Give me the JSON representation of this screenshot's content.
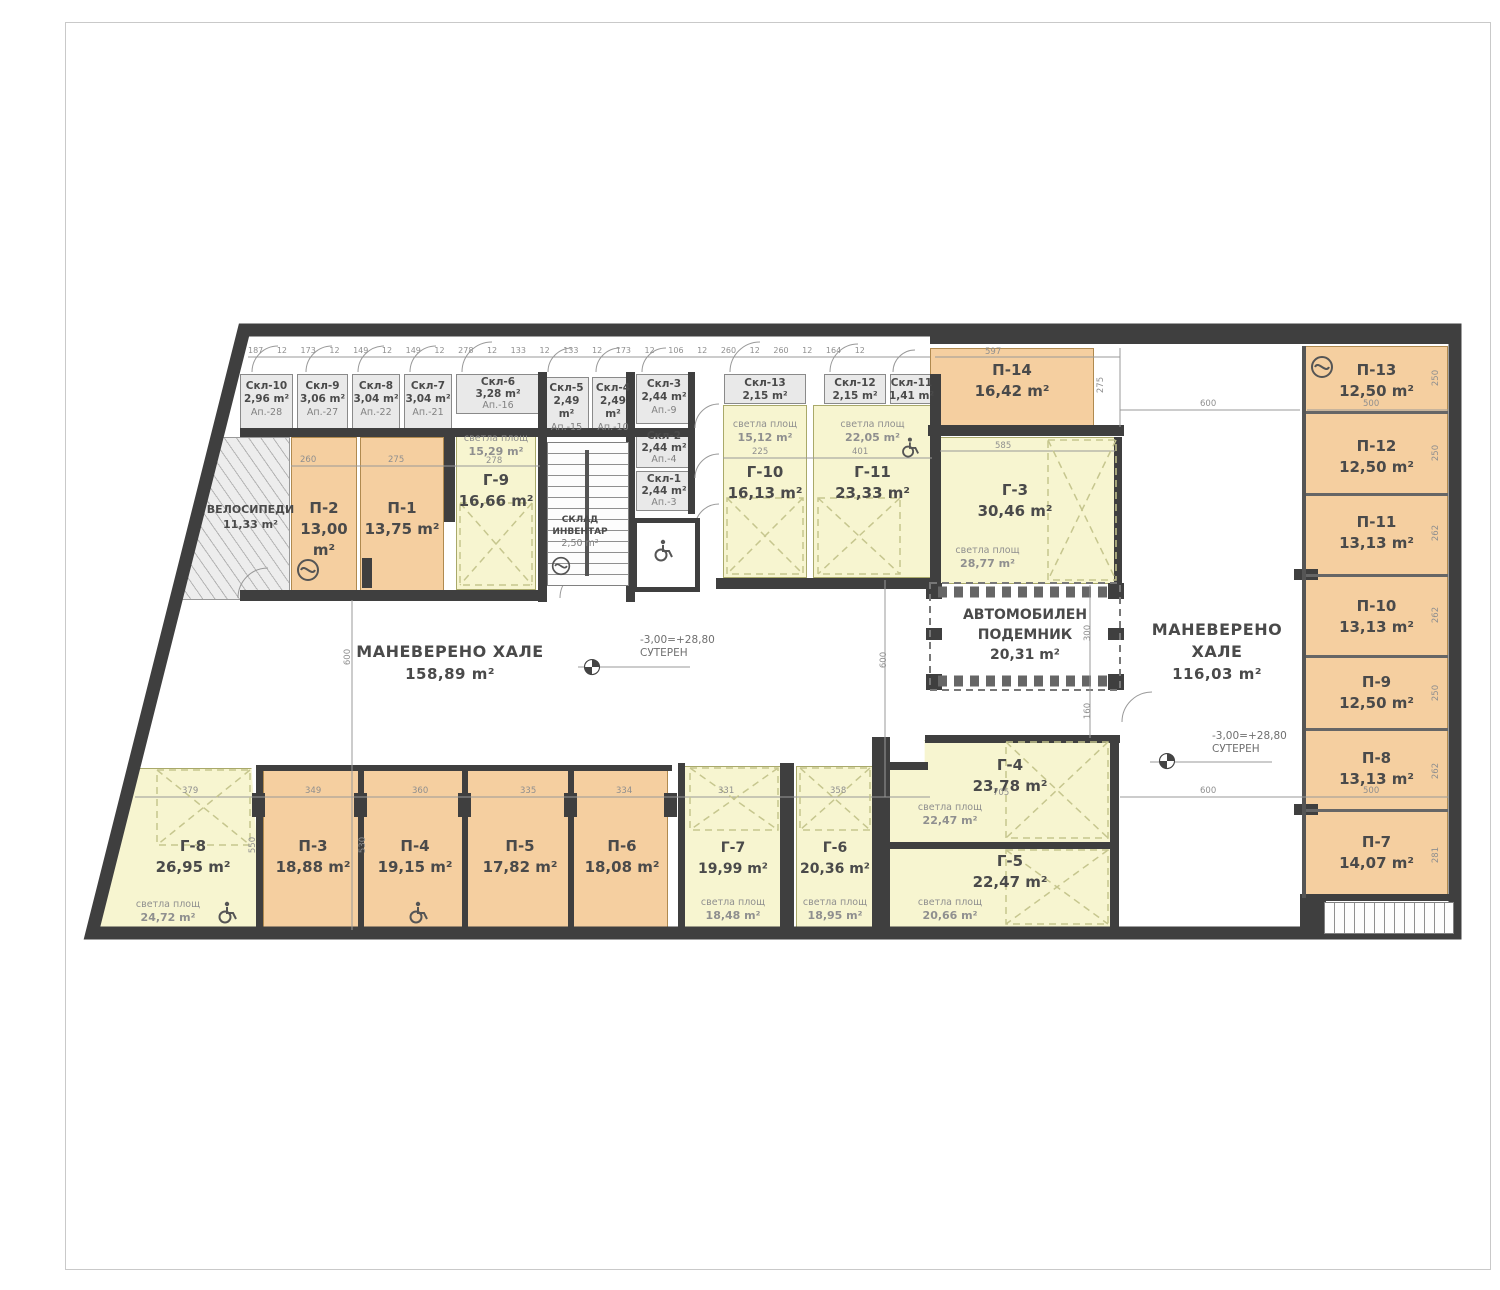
{
  "rooms": {
    "skl10": {
      "name": "Скл-10",
      "area": "2,96 m²",
      "apt": "Ап.-28"
    },
    "skl9": {
      "name": "Скл-9",
      "area": "3,06 m²",
      "apt": "Ап.-27"
    },
    "skl8": {
      "name": "Скл-8",
      "area": "3,04 m²",
      "apt": "Ап.-22"
    },
    "skl7": {
      "name": "Скл-7",
      "area": "3,04 m²",
      "apt": "Ап.-21"
    },
    "skl6": {
      "name": "Скл-6",
      "area": "3,28 m²",
      "apt": "Ап.-16"
    },
    "skl5": {
      "name": "Скл-5",
      "area": "2,49 m²",
      "apt": "Ап.-15"
    },
    "skl4": {
      "name": "Скл-4",
      "area": "2,49 m²",
      "apt": "Ап.-10"
    },
    "skl3": {
      "name": "Скл-3",
      "area": "2,44 m²",
      "apt": "Ап.-9"
    },
    "skl2": {
      "name": "Скл-2",
      "area": "2,44 m²",
      "apt": "Ап.-4"
    },
    "skl1": {
      "name": "Скл-1",
      "area": "2,44 m²",
      "apt": "Ап.-3"
    },
    "skl13": {
      "name": "Скл-13",
      "area": "2,15 m²"
    },
    "skl12": {
      "name": "Скл-12",
      "area": "2,15 m²"
    },
    "skl11": {
      "name": "Скл-11",
      "area": "1,41 m²"
    },
    "p1": {
      "name": "П-1",
      "area": "13,75 m²"
    },
    "p2": {
      "name": "П-2",
      "area": "13,00 m²"
    },
    "p3": {
      "name": "П-3",
      "area": "18,88 m²"
    },
    "p4": {
      "name": "П-4",
      "area": "19,15 m²"
    },
    "p5": {
      "name": "П-5",
      "area": "17,82 m²"
    },
    "p6": {
      "name": "П-6",
      "area": "18,08 m²"
    },
    "p7": {
      "name": "П-7",
      "area": "14,07 m²"
    },
    "p8": {
      "name": "П-8",
      "area": "13,13 m²"
    },
    "p9": {
      "name": "П-9",
      "area": "12,50 m²"
    },
    "p10": {
      "name": "П-10",
      "area": "13,13 m²"
    },
    "p11": {
      "name": "П-11",
      "area": "13,13 m²"
    },
    "p12": {
      "name": "П-12",
      "area": "12,50 m²"
    },
    "p13": {
      "name": "П-13",
      "area": "12,50 m²"
    },
    "p14": {
      "name": "П-14",
      "area": "16,42 m²"
    },
    "g3": {
      "name": "Г-3",
      "area": "30,46 m²",
      "svetla": "28,77 m²"
    },
    "g4": {
      "name": "Г-4",
      "area": "23,78 m²",
      "svetla": "22,47 m²"
    },
    "g5": {
      "name": "Г-5",
      "area": "22,47 m²",
      "svetla": "20,66 m²"
    },
    "g6": {
      "name": "Г-6",
      "area": "20,36 m²",
      "svetla": "18,95 m²"
    },
    "g7": {
      "name": "Г-7",
      "area": "19,99 m²",
      "svetla": "18,48 m²"
    },
    "g8": {
      "name": "Г-8",
      "area": "26,95 m²",
      "svetla": "24,72 m²"
    },
    "g9": {
      "name": "Г-9",
      "area": "16,66 m²",
      "svetla": "15,29 m²"
    },
    "g10": {
      "name": "Г-10",
      "area": "16,13 m²",
      "svetla": "15,12 m²"
    },
    "g11": {
      "name": "Г-11",
      "area": "23,33 m²",
      "svetla": "22,05 m²"
    },
    "bike": {
      "name": "ВЕЛОСИПЕДИ",
      "area": "11,33 m²"
    },
    "inventory": {
      "line1": "СКЛАД",
      "line2": "ИНВЕНТАР",
      "area": "2,50 m²"
    }
  },
  "halls": {
    "left": {
      "name": "МАНЕВЕРЕНО ХАЛЕ",
      "area": "158,89 m²"
    },
    "right": {
      "name": "МАНЕВЕРЕНО ХАЛЕ",
      "area": "116,03 m²"
    },
    "carlift": {
      "line1": "АВТОМОБИЛЕН",
      "line2": "ПОДЕМНИК",
      "area": "20,31 m²"
    }
  },
  "labels": {
    "svetla": "светла площ",
    "level": "-3,00=+28,80",
    "floor": "СУТЕРЕН"
  },
  "dims": {
    "top_row": "187 12 173 12 149 12 149 12 278 12 133 12 133 12 173 12 106 12 260 12 260 12 164 12",
    "d597": "597",
    "d275": "275",
    "d600a": "600",
    "d600b": "600",
    "d600v": "600",
    "d600c": "600",
    "d585": "585",
    "d260": "260",
    "d275b": "275",
    "d278": "278",
    "d225": "225",
    "d401": "401",
    "d705": "705",
    "d379": "379",
    "d349": "349",
    "d360": "360",
    "d335": "335",
    "d334": "334",
    "d331": "331",
    "d358": "358",
    "d500a": "500",
    "d500b": "500",
    "d250a": "250",
    "d250b": "250",
    "d250c": "250",
    "d262a": "262",
    "d262b": "262",
    "d262c": "262",
    "d281": "281",
    "d300": "300",
    "d160": "160",
    "d550": "550",
    "d530": "530"
  },
  "colors": {
    "wall": "#3f3f3f",
    "parking_orange": "#f5cfa0",
    "garage_yellow": "#f7f5d0",
    "storage_gray": "#e9e9e9",
    "dim_gray": "#8f8f8f"
  }
}
